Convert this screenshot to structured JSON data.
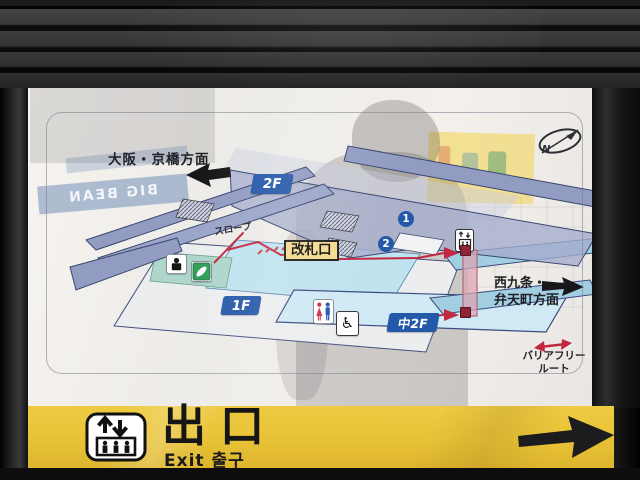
{
  "panel": {
    "direction_osaka": "大阪・京橋方面",
    "direction_west": "西九条・\n弁天町方面",
    "floor_2f": "2F",
    "floor_1f": "1F",
    "floor_m2f": "中2F",
    "slope": "スロープ",
    "ticket_gate": "改札口",
    "platform_no_1": "1",
    "platform_no_2": "2",
    "barrier_free": "バリアフリー\nルート",
    "north": "N"
  },
  "icons": {
    "wheelchair_glyph": "♿"
  },
  "reflection": {
    "shop_sign": "BIG BEAN"
  },
  "exit_sign": {
    "title": "出口",
    "subtitle": "Exit 출구"
  },
  "colors": {
    "sign_yellow": "#e8c236",
    "floor_label_blue": "#2458a8",
    "route_red": "#c22840",
    "gate_label_bg": "#f3d98e",
    "platform_fill": "#929cc2",
    "floor_1f_cyan": "#bfe3ef"
  }
}
